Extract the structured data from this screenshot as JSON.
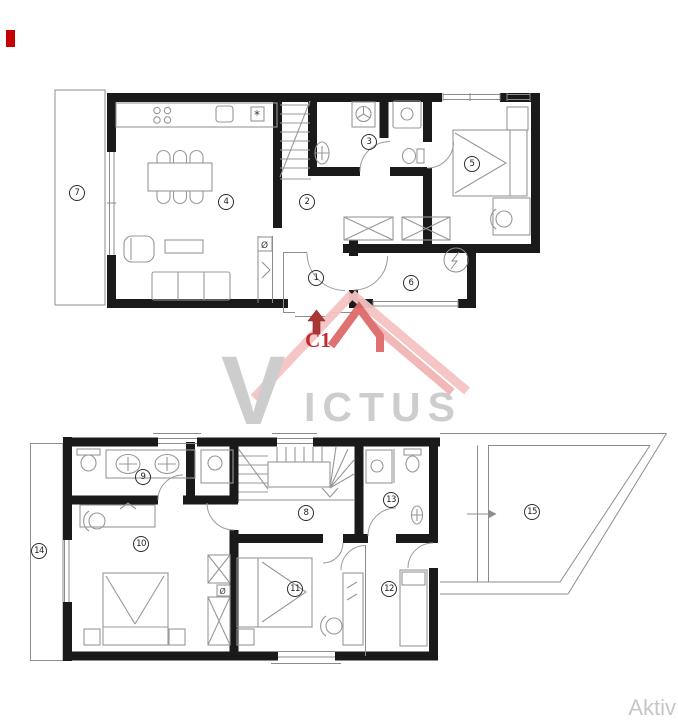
{
  "document": {
    "type": "floor-plan",
    "background": "#ffffff"
  },
  "rooms": [
    {
      "number": "1",
      "floor": "upper"
    },
    {
      "number": "2",
      "floor": "upper"
    },
    {
      "number": "3",
      "floor": "upper"
    },
    {
      "number": "4",
      "floor": "upper"
    },
    {
      "number": "5",
      "floor": "upper"
    },
    {
      "number": "6",
      "floor": "upper"
    },
    {
      "number": "7",
      "floor": "upper"
    },
    {
      "number": "8",
      "floor": "lower"
    },
    {
      "number": "9",
      "floor": "lower"
    },
    {
      "number": "10",
      "floor": "lower"
    },
    {
      "number": "11",
      "floor": "lower"
    },
    {
      "number": "12",
      "floor": "lower"
    },
    {
      "number": "13",
      "floor": "lower"
    },
    {
      "number": "14",
      "floor": "lower"
    },
    {
      "number": "15",
      "floor": "lower"
    }
  ],
  "entrance_marker": {
    "label": "C1",
    "color": "#c3282d"
  },
  "watermark": {
    "text": "VICTUS",
    "initial": "V",
    "rest": "ICTUS",
    "text_color": "#cbcbcb",
    "roof_color": "#f6c2c2",
    "roof_accent_color": "#df6a6a"
  },
  "footer": {
    "brand": "Aktiv",
    "color": "#c6c6c6"
  },
  "symbols": {
    "kitchen_asterisk": "*",
    "shaft_sign": "Ø"
  },
  "palette": {
    "wall": "#1a1a1a",
    "furniture_line": "#98989a",
    "marker_red": "#c40000",
    "arrow_red": "#aa3636"
  }
}
